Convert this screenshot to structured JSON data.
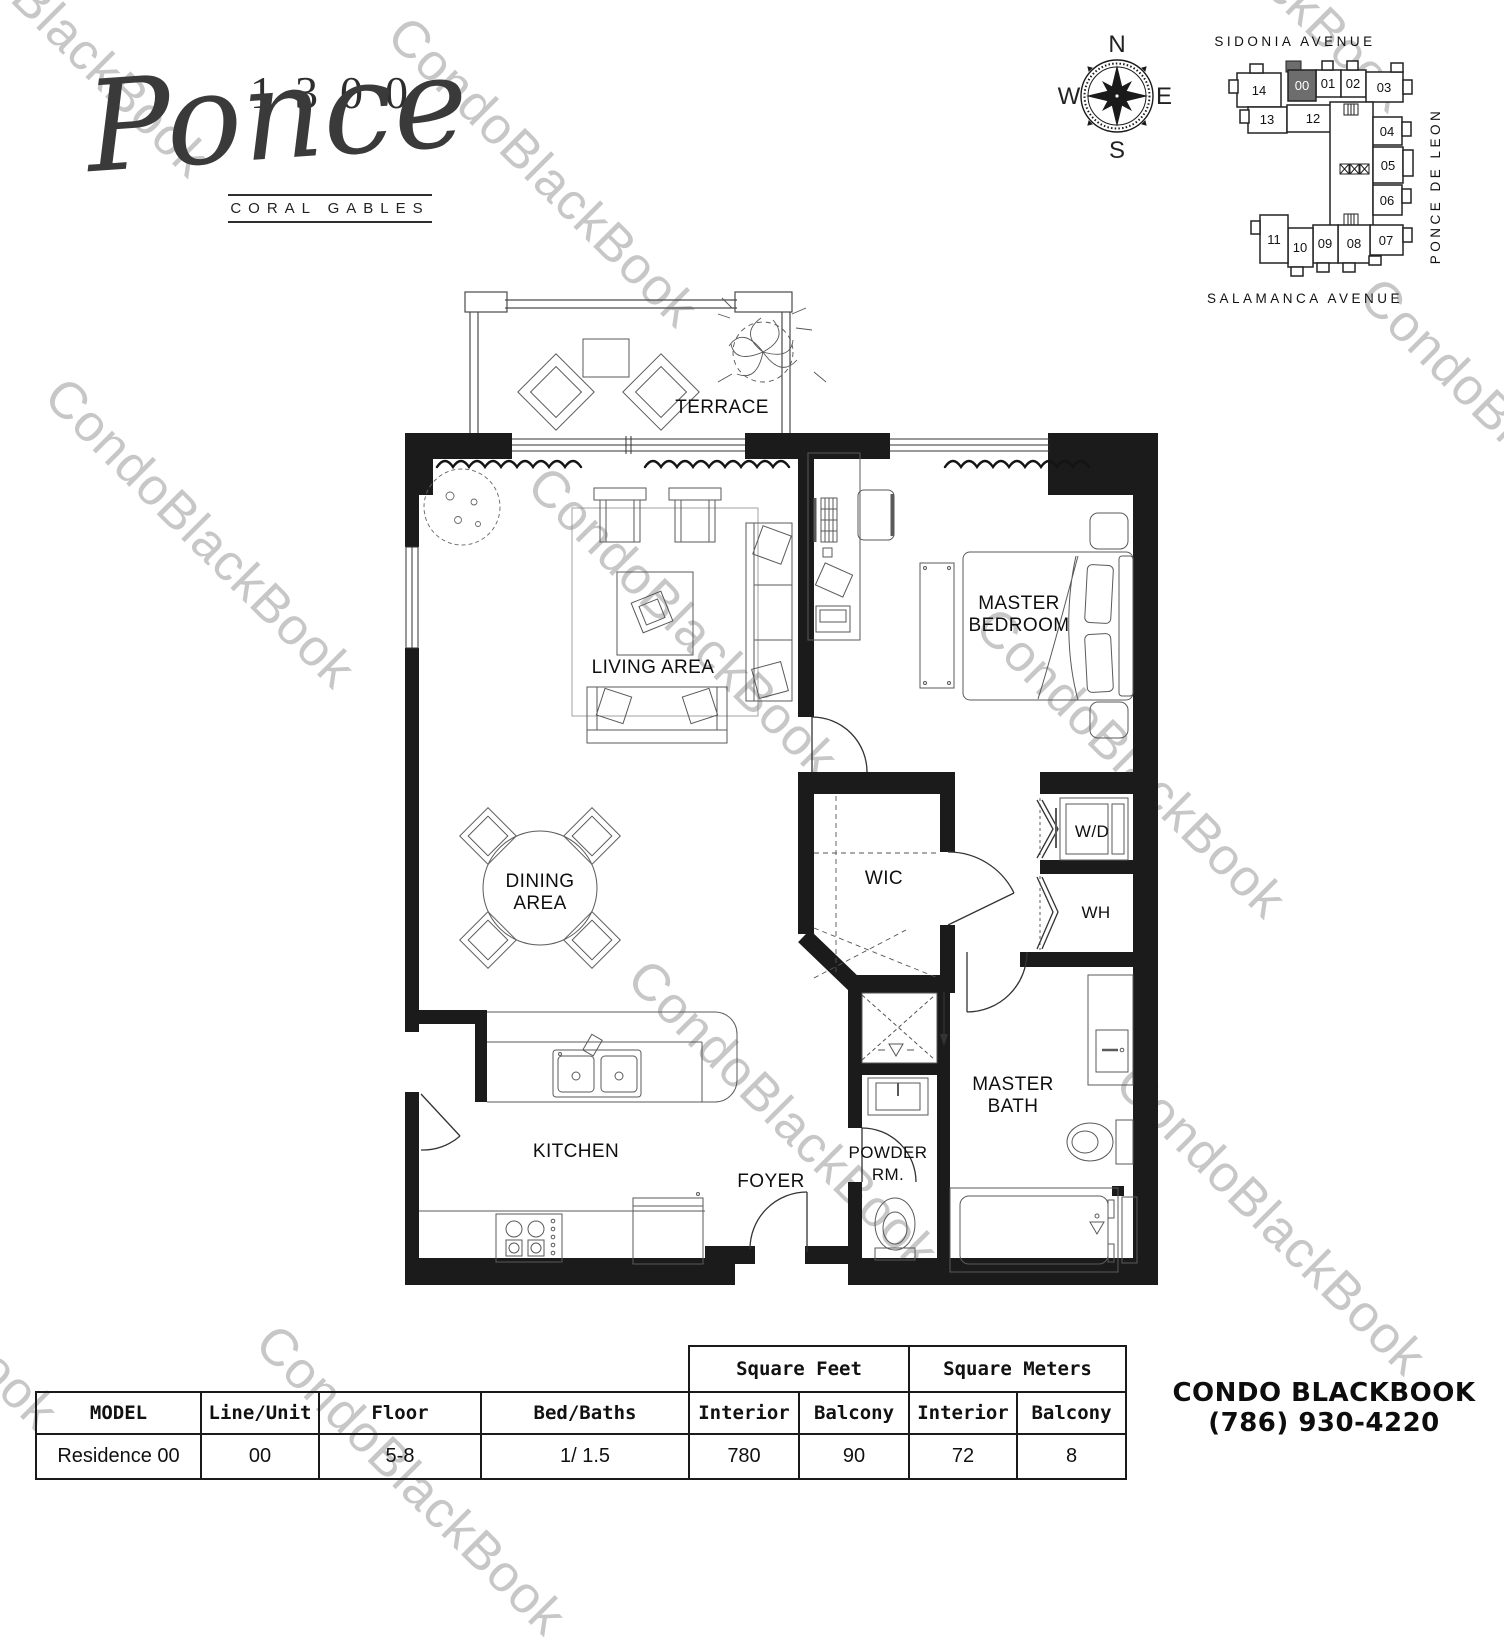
{
  "brand": {
    "number": "1300",
    "name": "Ponce",
    "city": "CORAL GABLES"
  },
  "compass": {
    "n": "N",
    "e": "E",
    "s": "S",
    "w": "W"
  },
  "keyplan": {
    "street_top": "SIDONIA AVENUE",
    "street_bottom": "SALAMANCA AVENUE",
    "street_right": "PONCE DE LEON",
    "highlighted_unit": "00",
    "highlight_color": "#6d6d6d",
    "units": [
      {
        "label": "14"
      },
      {
        "label": "00"
      },
      {
        "label": "01"
      },
      {
        "label": "02"
      },
      {
        "label": "03"
      },
      {
        "label": "13"
      },
      {
        "label": "12"
      },
      {
        "label": "04"
      },
      {
        "label": "05"
      },
      {
        "label": "06"
      },
      {
        "label": "07"
      },
      {
        "label": "08"
      },
      {
        "label": "09"
      },
      {
        "label": "10"
      },
      {
        "label": "11"
      }
    ]
  },
  "floorplan": {
    "rooms": {
      "terrace": "TERRACE",
      "living": "LIVING AREA",
      "master_bedroom_1": "MASTER",
      "master_bedroom_2": "BEDROOM",
      "dining_1": "DINING",
      "dining_2": "AREA",
      "wic": "WIC",
      "wd": "W/D",
      "wh": "WH",
      "kitchen": "KITCHEN",
      "foyer": "FOYER",
      "powder_1": "POWDER",
      "powder_2": "RM.",
      "master_bath_1": "MASTER",
      "master_bath_2": "BATH"
    }
  },
  "watermark": {
    "text": "CondoBlackBook",
    "color": "#c7c7c7"
  },
  "table": {
    "group_feet": "Square Feet",
    "group_meters": "Square Meters",
    "columns": [
      "MODEL",
      "Line/Unit",
      "Floor",
      "Bed/Baths",
      "Interior",
      "Balcony",
      "Interior",
      "Balcony"
    ],
    "row": [
      "Residence 00",
      "00",
      "5-8",
      "1/ 1.5",
      "780",
      "90",
      "72",
      "8"
    ]
  },
  "footer": {
    "company": "CONDO BLACKBOOK",
    "phone": "(786) 930-4220"
  }
}
